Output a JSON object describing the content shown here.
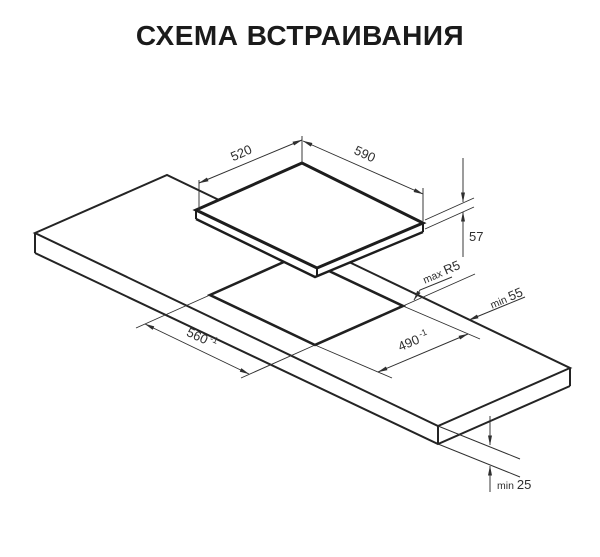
{
  "title": "СХЕМА ВСТРАИВАНИЯ",
  "labels": {
    "hob_top_depth": "520",
    "hob_top_width": "590",
    "hob_height": "57",
    "cutout_width": "560",
    "cutout_width_tol": "-1",
    "cutout_depth": "490",
    "cutout_depth_tol": "-1",
    "corner_radius_prefix": "max",
    "corner_radius_value": "R5",
    "rear_clearance_prefix": "min",
    "rear_clearance_value": "55",
    "worktop_thickness_prefix": "min",
    "worktop_thickness_value": "25"
  },
  "colors": {
    "ink": "#1d1d1d",
    "dimension": "#2f2f2f",
    "background": "#ffffff"
  }
}
